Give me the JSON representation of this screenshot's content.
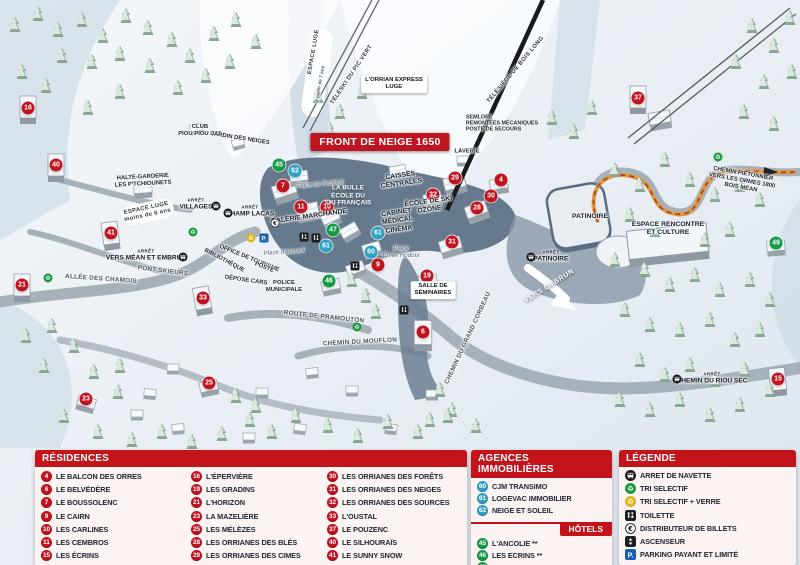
{
  "map": {
    "banner": "FRONT DE NEIGE 1650",
    "colors": {
      "residence": "#c01420",
      "hotel": "#129a48",
      "agence": "#2fa0c4",
      "header_red": "#c3141c"
    },
    "markers": [
      {
        "n": 16,
        "t": "residence",
        "x": 28,
        "y": 108
      },
      {
        "n": 40,
        "t": "residence",
        "x": 56,
        "y": 165
      },
      {
        "n": 21,
        "t": "residence",
        "x": 22,
        "y": 285
      },
      {
        "n": 41,
        "t": "residence",
        "x": 111,
        "y": 233
      },
      {
        "n": 33,
        "t": "residence",
        "x": 203,
        "y": 298
      },
      {
        "n": 23,
        "t": "residence",
        "x": 86,
        "y": 399
      },
      {
        "n": 25,
        "t": "residence",
        "x": 209,
        "y": 383
      },
      {
        "n": 7,
        "t": "residence",
        "x": 283,
        "y": 186
      },
      {
        "n": 11,
        "t": "residence",
        "x": 301,
        "y": 207
      },
      {
        "n": 10,
        "t": "residence",
        "x": 327,
        "y": 207
      },
      {
        "n": 9,
        "t": "residence",
        "x": 378,
        "y": 265
      },
      {
        "n": 29,
        "t": "residence",
        "x": 455,
        "y": 178
      },
      {
        "n": 4,
        "t": "residence",
        "x": 501,
        "y": 180
      },
      {
        "n": 32,
        "t": "residence",
        "x": 433,
        "y": 195
      },
      {
        "n": 30,
        "t": "residence",
        "x": 491,
        "y": 196
      },
      {
        "n": 28,
        "t": "residence",
        "x": 477,
        "y": 208
      },
      {
        "n": 31,
        "t": "residence",
        "x": 452,
        "y": 242
      },
      {
        "n": 19,
        "t": "residence",
        "x": 427,
        "y": 276
      },
      {
        "n": 6,
        "t": "residence",
        "x": 423,
        "y": 332
      },
      {
        "n": 37,
        "t": "residence",
        "x": 638,
        "y": 98
      },
      {
        "n": 15,
        "t": "residence",
        "x": 778,
        "y": 379
      },
      {
        "n": 45,
        "t": "hotel",
        "x": 279,
        "y": 165
      },
      {
        "n": 47,
        "t": "hotel",
        "x": 333,
        "y": 230
      },
      {
        "n": 46,
        "t": "hotel",
        "x": 329,
        "y": 281
      },
      {
        "n": 49,
        "t": "hotel",
        "x": 776,
        "y": 243
      },
      {
        "n": 62,
        "t": "agence",
        "x": 295,
        "y": 171
      },
      {
        "n": 61,
        "t": "agence",
        "x": 378,
        "y": 233
      },
      {
        "n": 61,
        "t": "agence",
        "x": 326,
        "y": 246
      },
      {
        "n": 60,
        "t": "agence",
        "x": 371,
        "y": 252
      }
    ],
    "labels": [
      {
        "lines": [
          "ESPACE LUGE"
        ],
        "x": 314,
        "y": 52,
        "r": -80,
        "k": "lift"
      },
      {
        "lines": [
          "à partir de 7 ans"
        ],
        "x": 321,
        "y": 84,
        "r": -80,
        "k": "tiny"
      },
      {
        "lines": [
          "TÉLÉSKI DU PIC VERT"
        ],
        "x": 352,
        "y": 75,
        "r": -56,
        "k": "lift"
      },
      {
        "lines": [
          "L'ORRIAN EXPRESS",
          "LUGE"
        ],
        "x": 394,
        "y": 84,
        "r": 0,
        "k": "whitebox"
      },
      {
        "lines": [
          "TÉLÉSIÈGE DE BOIS LONG"
        ],
        "x": 516,
        "y": 70,
        "r": -50,
        "k": "lift"
      },
      {
        "lines": [
          "SEMLORE",
          "REMONTÉES MÉCANIQUES",
          "POSTE DE SECOURS"
        ],
        "x": 502,
        "y": 124,
        "r": 0,
        "k": "poi-left"
      },
      {
        "lines": [
          "FRONT DE NEIGE 1650"
        ],
        "x": 380,
        "y": 142,
        "r": 0,
        "k": "banner"
      },
      {
        "lines": [
          "LAVERIE"
        ],
        "x": 467,
        "y": 152,
        "r": 0,
        "k": "poi-sm"
      },
      {
        "lines": [
          "CLUB",
          "PIOU PIOU ESF"
        ],
        "x": 200,
        "y": 131,
        "r": 0,
        "k": "poi-sm"
      },
      {
        "lines": [
          "JARDIN DES NEIGES"
        ],
        "x": 240,
        "y": 139,
        "r": 9,
        "k": "poi-sm"
      },
      {
        "lines": [
          "HALTE-GARDERIE",
          "LES P'TCHIOUNETS"
        ],
        "x": 143,
        "y": 181,
        "r": -3,
        "k": "poi-sm"
      },
      {
        "lines": [
          "ESPACE LUGE",
          "moins de 6 ans"
        ],
        "x": 147,
        "y": 212,
        "r": -12,
        "k": "lift"
      },
      {
        "lines": [
          "ARRÊT",
          "VILLAGES"
        ],
        "x": 196,
        "y": 205,
        "r": 0,
        "k": "stop"
      },
      {
        "lines": [
          "ARRÊT",
          "CHAMP LACAS"
        ],
        "x": 250,
        "y": 212,
        "r": 0,
        "k": "stop"
      },
      {
        "lines": [
          "ARRÊT",
          "VERS MÉAN ET EMBRUN"
        ],
        "x": 146,
        "y": 256,
        "r": 0,
        "k": "stop"
      },
      {
        "lines": [
          "PONT SKIEURS"
        ],
        "x": 163,
        "y": 271,
        "r": 7,
        "k": "road"
      },
      {
        "lines": [
          "ALLÉE DES CHAMOIS"
        ],
        "x": 101,
        "y": 279,
        "r": 4,
        "k": "road"
      },
      {
        "lines": [
          "BIBLIOTHÈQUE"
        ],
        "x": 224,
        "y": 261,
        "r": 28,
        "k": "poi-sm"
      },
      {
        "lines": [
          "OFFICE DE TOURISME"
        ],
        "x": 249,
        "y": 259,
        "r": 22,
        "k": "poi-sm"
      },
      {
        "lines": [
          "POSTE"
        ],
        "x": 264,
        "y": 268,
        "r": 22,
        "k": "poi-sm"
      },
      {
        "lines": [
          "DÉPOSE CARS"
        ],
        "x": 246,
        "y": 281,
        "r": 8,
        "k": "poi-sm"
      },
      {
        "lines": [
          "POLICE",
          "MUNICIPALE"
        ],
        "x": 284,
        "y": 287,
        "r": 0,
        "k": "poi-sm"
      },
      {
        "lines": [
          "Place d'accueil"
        ],
        "x": 284,
        "y": 252,
        "r": -5,
        "k": "place"
      },
      {
        "lines": [
          "Place du Festival"
        ],
        "x": 320,
        "y": 184,
        "r": -5,
        "k": "place"
      },
      {
        "lines": [
          "Place",
          "Émile Hodoul"
        ],
        "x": 401,
        "y": 252,
        "r": 0,
        "k": "place"
      },
      {
        "lines": [
          "LA BULLE",
          "ÉCOLE DU",
          "SKI FRANÇAIS"
        ],
        "x": 348,
        "y": 196,
        "r": 0,
        "k": "white-poi"
      },
      {
        "lines": [
          "GALERIE MARCHANDE"
        ],
        "x": 309,
        "y": 217,
        "r": -8,
        "k": "poi"
      },
      {
        "lines": [
          "CAISSES",
          "CENTRALES"
        ],
        "x": 401,
        "y": 180,
        "r": -8,
        "k": "poi"
      },
      {
        "lines": [
          "ÉCOLE DE SKI",
          "OZONE"
        ],
        "x": 429,
        "y": 206,
        "r": -8,
        "k": "poi"
      },
      {
        "lines": [
          "CABINET",
          "MÉDICAL"
        ],
        "x": 397,
        "y": 217,
        "r": -8,
        "k": "poi"
      },
      {
        "lines": [
          "CINÉMA"
        ],
        "x": 399,
        "y": 230,
        "r": -8,
        "k": "poi"
      },
      {
        "lines": [
          "SALLE DE",
          "SÉMINAIRES"
        ],
        "x": 433,
        "y": 290,
        "r": 0,
        "k": "whitebox"
      },
      {
        "lines": [
          "PATINOIRE"
        ],
        "x": 590,
        "y": 217,
        "r": 0,
        "k": "poi"
      },
      {
        "lines": [
          "ARRÊT",
          "PATINOIRE"
        ],
        "x": 551,
        "y": 257,
        "r": 0,
        "k": "stop"
      },
      {
        "lines": [
          "VERS EMBRUN"
        ],
        "x": 549,
        "y": 286,
        "r": -32,
        "k": "white-road"
      },
      {
        "lines": [
          "ESPACE RENCONTRE",
          "ET CULTURE"
        ],
        "x": 668,
        "y": 229,
        "r": 0,
        "k": "poi"
      },
      {
        "lines": [
          "CHEMIN PIÉTONNIER",
          "VERS LES ORMES 1800",
          "BOIS MÉAN"
        ],
        "x": 742,
        "y": 181,
        "r": 10,
        "k": "poi-sm"
      },
      {
        "lines": [
          "ARRÊT",
          "CHEMIN DU RIOU SEC"
        ],
        "x": 712,
        "y": 379,
        "r": 0,
        "k": "stop"
      },
      {
        "lines": [
          "ROUTE DE PRAMOUTON"
        ],
        "x": 324,
        "y": 317,
        "r": 6,
        "k": "road"
      },
      {
        "lines": [
          "CHEMIN DU MOUFLON"
        ],
        "x": 360,
        "y": 342,
        "r": -3,
        "k": "road"
      },
      {
        "lines": [
          "CHEMIN DU GRAND CORBEAU"
        ],
        "x": 468,
        "y": 338,
        "r": -65,
        "k": "road"
      }
    ],
    "icons": [
      {
        "type": "bus",
        "x": 216,
        "y": 206
      },
      {
        "type": "bus",
        "x": 228,
        "y": 213
      },
      {
        "type": "bus",
        "x": 183,
        "y": 257
      },
      {
        "type": "bus",
        "x": 531,
        "y": 257
      },
      {
        "type": "bus",
        "x": 677,
        "y": 379
      },
      {
        "type": "euro",
        "x": 275,
        "y": 223
      },
      {
        "type": "parking",
        "x": 264,
        "y": 238
      },
      {
        "type": "recycle-yellow",
        "x": 251,
        "y": 238
      },
      {
        "type": "wc",
        "x": 304,
        "y": 237
      },
      {
        "type": "wc",
        "x": 316,
        "y": 238
      },
      {
        "type": "wc",
        "x": 355,
        "y": 266
      },
      {
        "type": "wc",
        "x": 404,
        "y": 310
      },
      {
        "type": "recycle",
        "x": 48,
        "y": 278
      },
      {
        "type": "recycle",
        "x": 193,
        "y": 232
      },
      {
        "type": "recycle",
        "x": 357,
        "y": 327
      },
      {
        "type": "recycle",
        "x": 718,
        "y": 157
      }
    ]
  },
  "panels": {
    "residences": {
      "title": "RÉSIDENCES",
      "columns": [
        [
          {
            "n": 4,
            "label": "LE BALCON DES ORRES"
          },
          {
            "n": 6,
            "label": "LE BELVÉDÈRE"
          },
          {
            "n": 7,
            "label": "LE BOUSSOLENC"
          },
          {
            "n": 9,
            "label": "LE CAIRN"
          },
          {
            "n": 10,
            "label": "LES CARLINES"
          },
          {
            "n": 11,
            "label": "LES CEMBROS"
          },
          {
            "n": 15,
            "label": "LES ÉCRINS"
          }
        ],
        [
          {
            "n": 16,
            "label": "L'ÉPERVIÈRE"
          },
          {
            "n": 19,
            "label": "LES GRADINS"
          },
          {
            "n": 21,
            "label": "L'HORIZON"
          },
          {
            "n": 23,
            "label": "LA MAZELIÈRE"
          },
          {
            "n": 25,
            "label": "LES MÉLÈZES"
          },
          {
            "n": 28,
            "label": "LES ORRIANES DES BLÉS"
          },
          {
            "n": 29,
            "label": "LES ORRIANES DES CIMES"
          }
        ],
        [
          {
            "n": 30,
            "label": "LES ORRIANES DES FORÊTS"
          },
          {
            "n": 31,
            "label": "LES ORRIANES DES NEIGES"
          },
          {
            "n": 32,
            "label": "LES ORRIANES DES SOURCES"
          },
          {
            "n": 33,
            "label": "L'OUSTAL"
          },
          {
            "n": 37,
            "label": "LE POUZENC"
          },
          {
            "n": 40,
            "label": "LE SILHOURAÏS"
          },
          {
            "n": 41,
            "label": "LE SUNNY SNOW"
          }
        ]
      ]
    },
    "agences": {
      "title": "AGENCES IMMOBILIÈRES",
      "items": [
        {
          "n": 60,
          "label": "CJM TRANSIMO"
        },
        {
          "n": 61,
          "label": "LOGEVAC IMMOBILIER"
        },
        {
          "n": 62,
          "label": "NEIGE ET SOLEIL"
        }
      ]
    },
    "hotels": {
      "title": "HÔTELS",
      "items": [
        {
          "n": 45,
          "label": "L'ANCOLIE **"
        },
        {
          "n": 46,
          "label": "LES ECRINS **"
        },
        {
          "n": 47,
          "label": "L'ESCALE BLANCHE ***"
        },
        {
          "n": 49,
          "label": "LES TRAPPEURS **"
        }
      ]
    },
    "legende": {
      "title": "LÉGENDE",
      "items": [
        {
          "icon": "bus",
          "label": "ARRET DE NAVETTE"
        },
        {
          "icon": "recycle",
          "label": "TRI SELECTIF"
        },
        {
          "icon": "recycle-yellow",
          "label": "TRI SELECTIF + VERRE"
        },
        {
          "icon": "wc",
          "label": "TOILETTE"
        },
        {
          "icon": "euro",
          "label": "DISTRIBUTEUR DE BILLETS"
        },
        {
          "icon": "elevator",
          "label": "ASCENSEUR"
        },
        {
          "icon": "parking",
          "label": "PARKING PAYANT ET LIMITÉ"
        }
      ]
    }
  }
}
